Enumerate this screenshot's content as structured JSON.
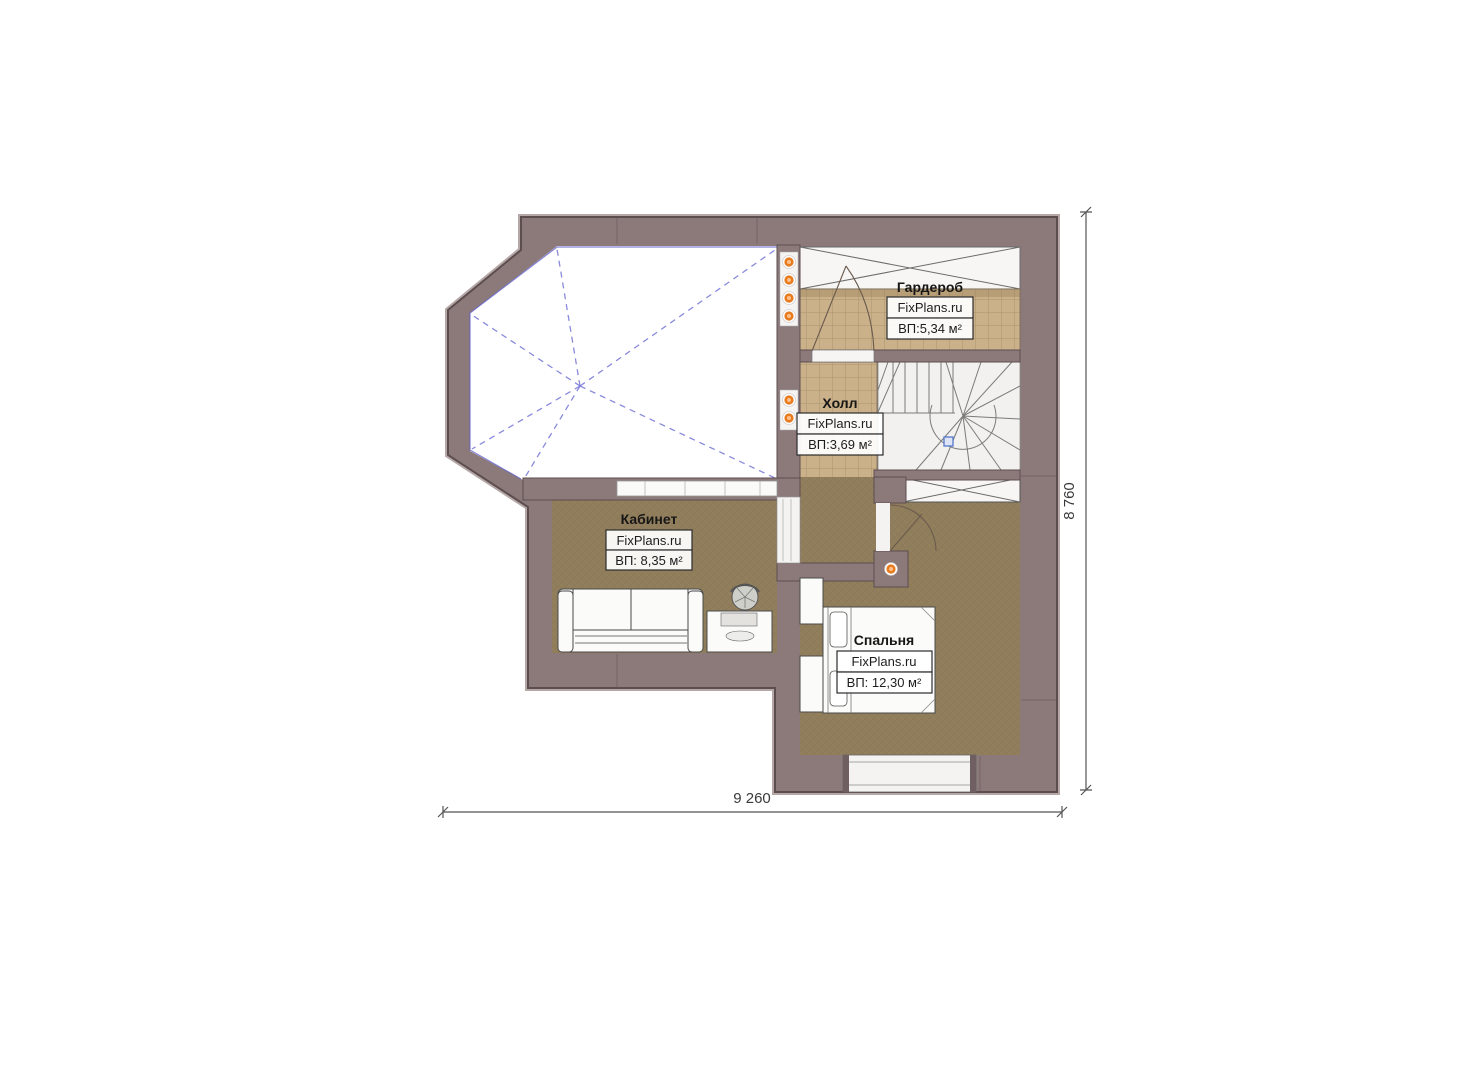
{
  "watermark": "FixPlans.ru",
  "rooms": {
    "wardrobe": {
      "name": "Гардероб",
      "watermark": "FixPlans.ru",
      "area": "ВП:5,34 м²"
    },
    "hall": {
      "name": "Холл",
      "watermark": "FixPlans.ru",
      "area": "ВП:3,69 м²"
    },
    "office": {
      "name": "Кабинет",
      "watermark": "FixPlans.ru",
      "area": "ВП: 8,35 м²"
    },
    "bedroom": {
      "name": "Спальня",
      "watermark": "FixPlans.ru",
      "area": "ВП: 12,30 м²"
    }
  },
  "dimensions": {
    "bottom": "9 260",
    "right": "8 760"
  },
  "colors": {
    "wall": "#8c7a7b",
    "wall_edge": "#5c4d4f",
    "tile_floor": "#cbb189",
    "carpet_floor": "#907d5b",
    "stairs_bg": "#f2f1ef",
    "void_dash_blue": "#7d7dd8",
    "light_orange": "#e87b1e"
  }
}
